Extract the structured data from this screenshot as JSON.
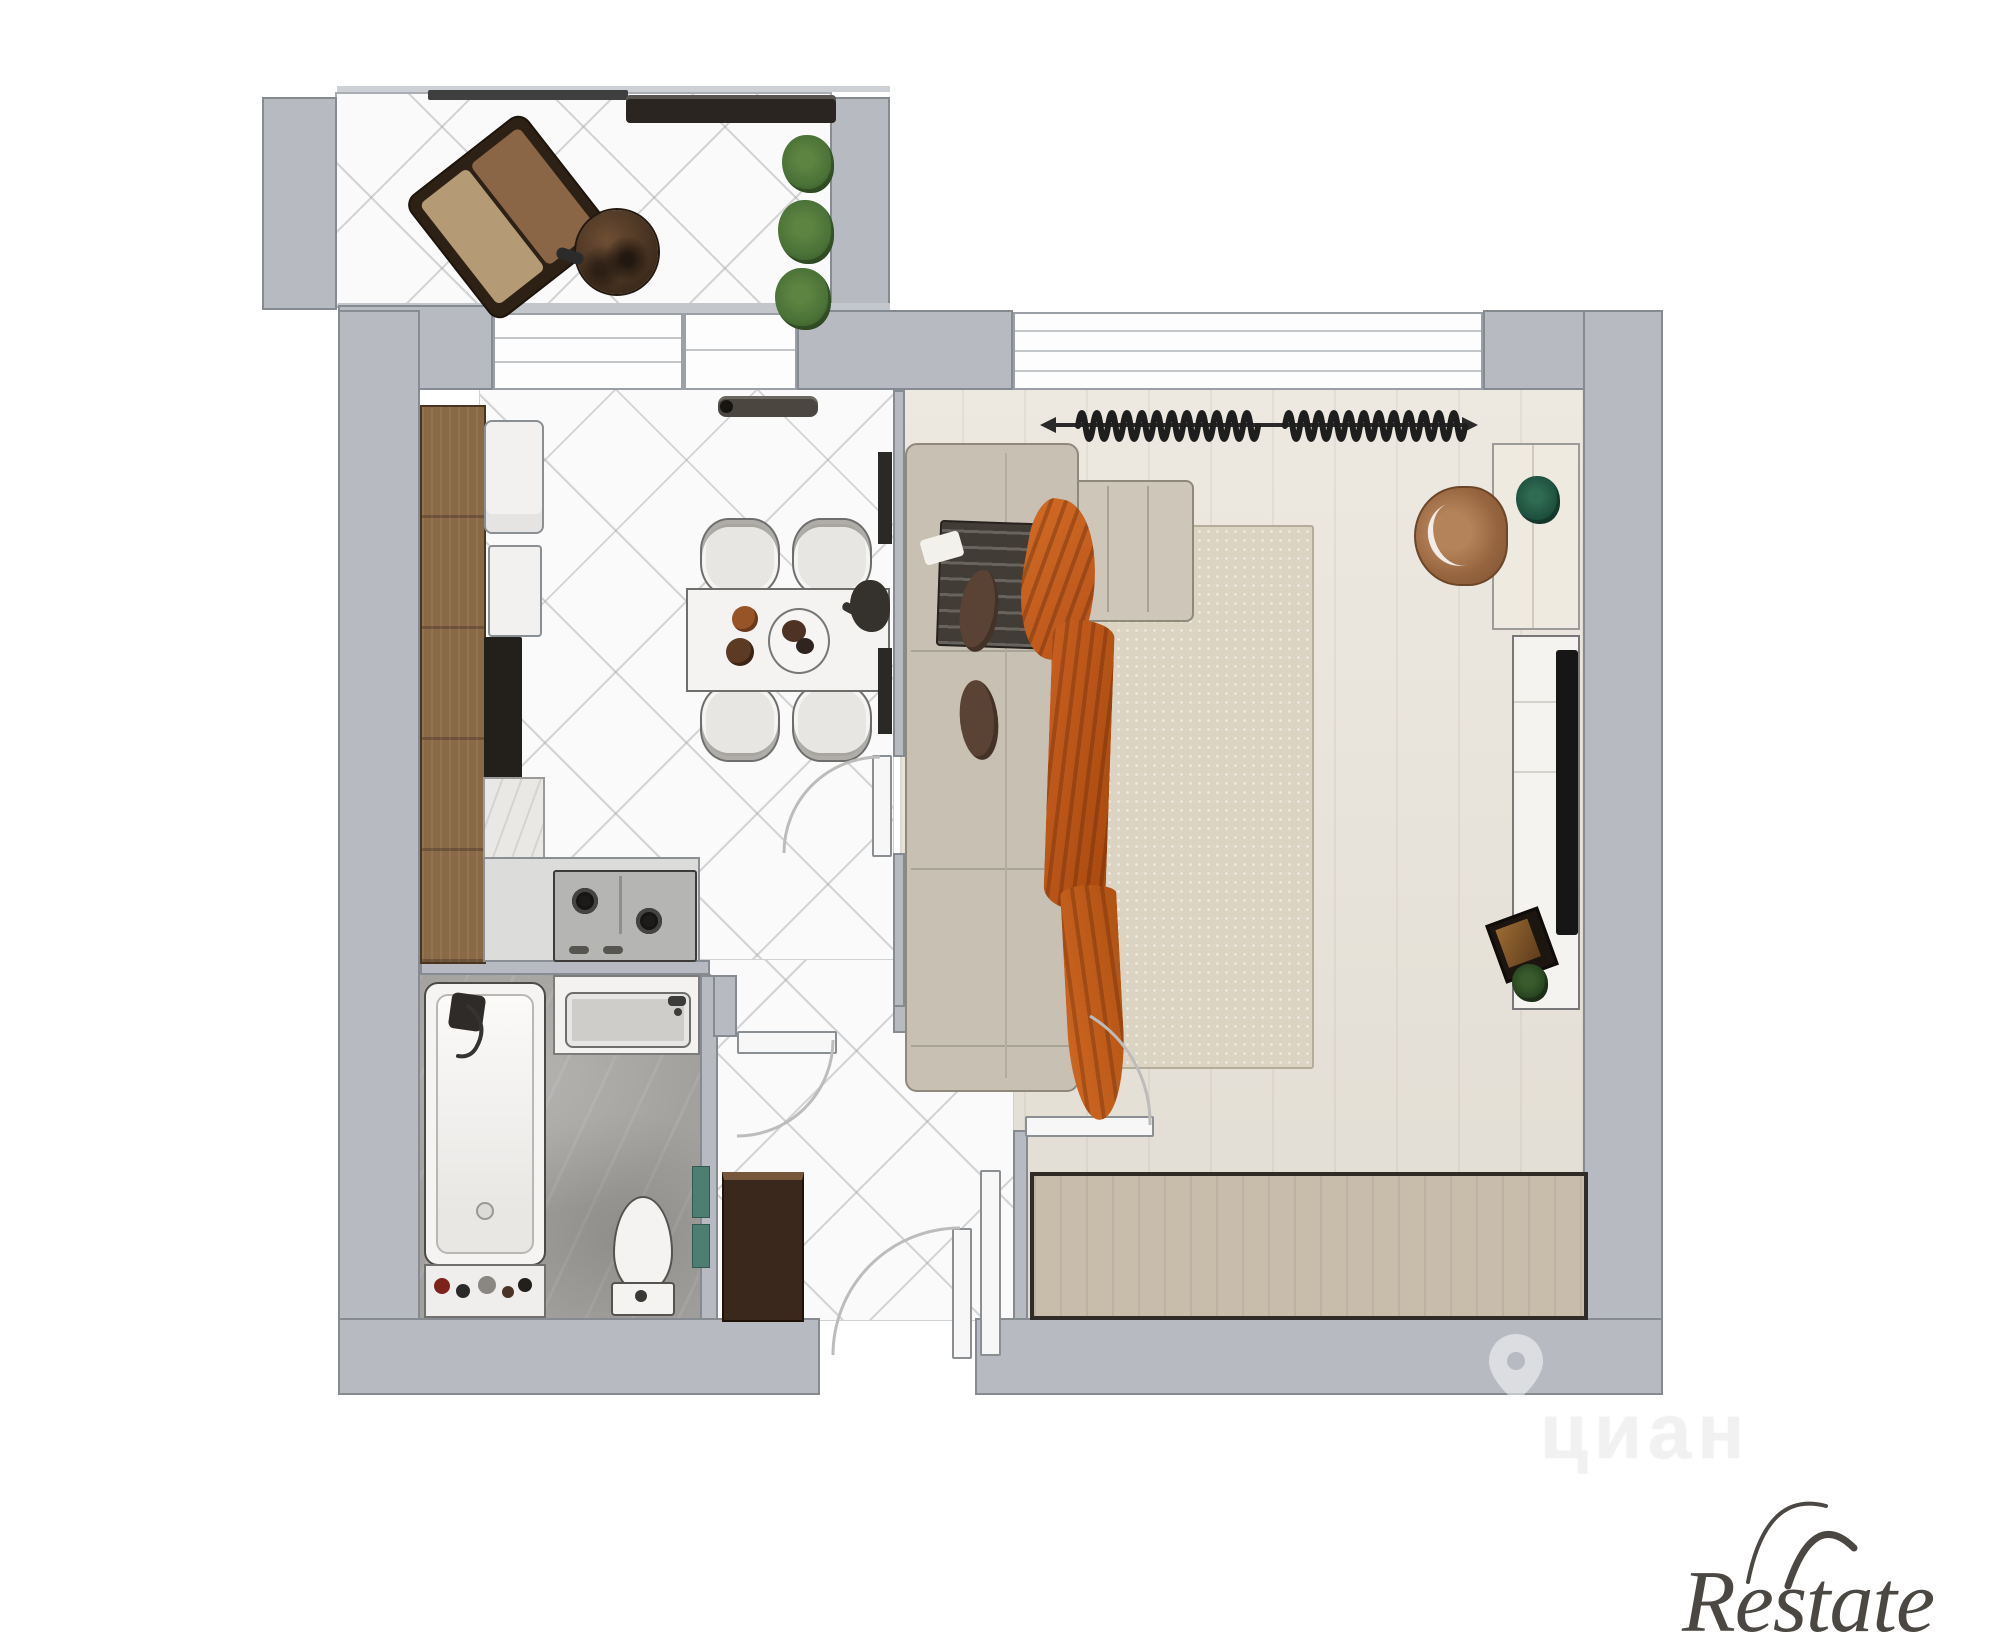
{
  "title": "apartment-floor-plan-render",
  "watermarks": {
    "portal_name": "циан",
    "portal_pin_icon": "location-pin",
    "brand_name": "Restate"
  },
  "palette": {
    "canvas_bg": "#ffffff",
    "wall_fill": "#b7bbc1",
    "wall_edge": "#868b92",
    "tile_floor": "#fafafa",
    "wood_floor": "#e9e4da",
    "bath_floor": "#a3a19e",
    "cabinet_wood": "#8a6947",
    "counter_gray": "#dcdcda",
    "cooktop_gray": "#b5b5b3",
    "appliance_white": "#f2f1ef",
    "black_unit": "#23201c",
    "table_white": "#f4f3f1",
    "chair_gray": "#e8e6e2",
    "sofa_beige": "#c7c0b3",
    "chaise_beige": "#cdc6b9",
    "pillow_brown": "#5a4334",
    "pillow_striped": "#413c35",
    "throw_orange": "#c4601f",
    "rug_beige": "#dcd4c3",
    "armchair_cognac": "#9c6c46",
    "desk_cream": "#efeadf",
    "tv_black": "#161616",
    "sideboard_tan": "#c8bdab",
    "wardrobe_brown": "#39281b",
    "balcony_chair_brown": "#8a6647",
    "plant_green": "#4c7338",
    "towel_teal": "#4e7d72",
    "curtain_dark": "#222222",
    "door_leaf": "#f7f7f7",
    "arc_gray": "#bdbcba",
    "logo_color": "#4b4742",
    "watermark_ghost": "#f1f1f1"
  },
  "rooms": {
    "balcony": {
      "items": [
        "lounge-chair",
        "round-side-table",
        "plants",
        "glazing-frame"
      ]
    },
    "kitchen": {
      "items": [
        "tall-cabinet",
        "fridge",
        "oven",
        "black-appliance",
        "counter",
        "cooktop",
        "radiator"
      ]
    },
    "dining": {
      "items": [
        "dining-table",
        "four-chairs",
        "tableware",
        "wall-shelves"
      ]
    },
    "bathroom": {
      "items": [
        "bathtub",
        "shower-head",
        "vanity-sink",
        "toilet",
        "towels",
        "toiletry-shelf"
      ]
    },
    "hallway": {
      "items": [
        "wardrobe",
        "entry-door",
        "bathroom-door",
        "door-swing-arcs"
      ]
    },
    "living_room": {
      "items": [
        "corner-sofa",
        "orange-throw",
        "pillows",
        "rug",
        "desk",
        "desk-chair",
        "desk-plant",
        "tv-stand",
        "tv",
        "sideboard",
        "curtains",
        "window"
      ]
    }
  }
}
